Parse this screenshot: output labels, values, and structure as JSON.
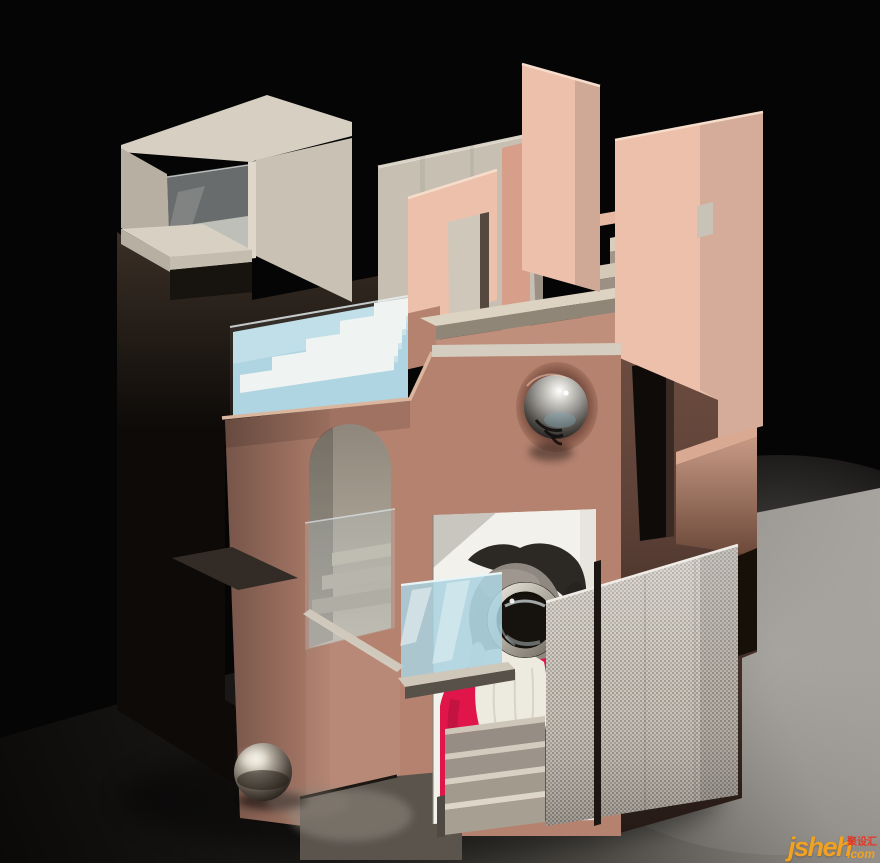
{
  "meta": {
    "kind": "3d-architectural-render",
    "subject": "abstract pink and concrete pavilion model with pool stairs, arched niche, chrome spheres, perforated mesh screen and schnauzer-dog artwork on black backdrop"
  },
  "palette": {
    "bg": "#060505",
    "floor_dark": "#0b0a09",
    "floor_light": "#a3a09c",
    "concrete_light": "#d6cfc2",
    "concrete_mid": "#c7c0b2",
    "concrete_shadow": "#a89f92",
    "glass": "#ccd4d4",
    "pool_water": "#a9d2e0",
    "pool_step": "#eef4f3",
    "pink_panel": "#ecc0ab",
    "pink_deep": "#d79f89",
    "rose_wall": "#b5826f",
    "rose_shadow": "#8f6355",
    "mauve_tower": "#6e4d41",
    "dark_brown": "#2a211b",
    "near_black": "#0e0b09",
    "mesh_silver": "#c8c2b8",
    "mesh_dot": "#665f56",
    "chrome_light": "#f2eee6",
    "chrome_dark": "#17130f",
    "arch_interior": "#b0a89b",
    "edge_highlight": "#f2e3d4",
    "dog_coat_red": "#e0164a",
    "dog_fur_gray": "#8f8880",
    "dog_fur_dark": "#2c2925",
    "dog_white": "#edebdf"
  },
  "watermark": {
    "brand": "jsheh",
    "cjk": "聚设汇",
    "tld": ".com",
    "orange": "#f7a41c",
    "red": "#e8331f"
  }
}
